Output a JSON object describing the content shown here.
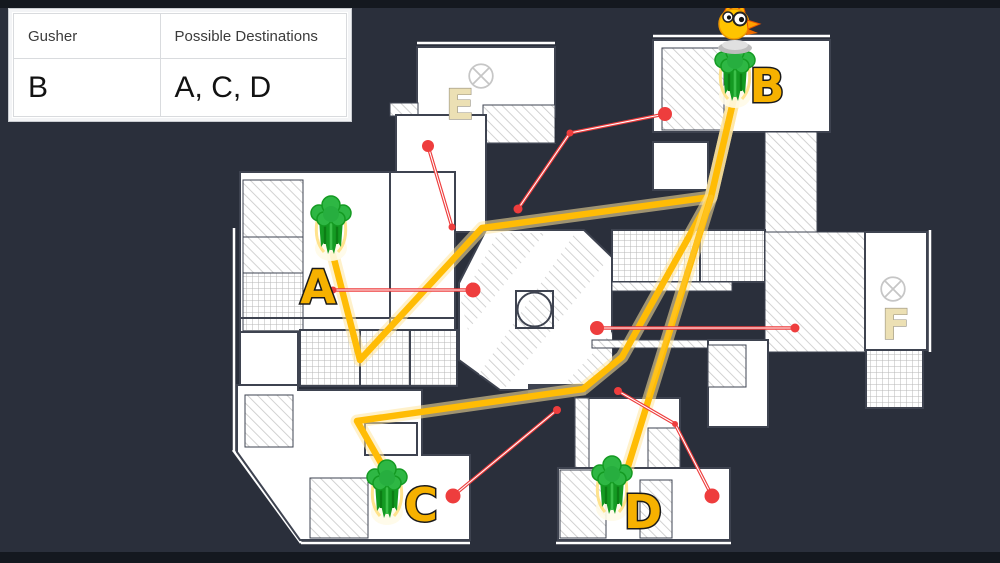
{
  "table": {
    "headers": [
      "Gusher",
      "Possible Destinations"
    ],
    "rows": [
      {
        "gusher": "B",
        "destinations": "A, C, D"
      }
    ]
  },
  "map": {
    "colors": {
      "background": "#2a2f3b",
      "letterbox": "#14181f",
      "path_yellow": "#ffbc05",
      "callout_red": "#ee3d3d",
      "gusher_label_yellow": "#f6b100",
      "site_label_cream": "#ece0b4",
      "gusher_green": "#149a22"
    },
    "gushers": [
      {
        "id": "A",
        "label": "A",
        "icon_x": 331,
        "icon_y": 228,
        "label_x": 318,
        "label_y": 303,
        "has_character": false
      },
      {
        "id": "B",
        "label": "B",
        "icon_x": 735,
        "icon_y": 75,
        "label_x": 767,
        "label_y": 102,
        "has_character": true
      },
      {
        "id": "C",
        "label": "C",
        "icon_x": 387,
        "icon_y": 492,
        "label_x": 421,
        "label_y": 521,
        "has_character": false
      },
      {
        "id": "D",
        "label": "D",
        "icon_x": 612,
        "icon_y": 488,
        "label_x": 643,
        "label_y": 528,
        "has_character": false
      }
    ],
    "sites": [
      {
        "id": "E",
        "label": "E",
        "label_x": 460,
        "label_y": 119,
        "marker_x": 481,
        "marker_y": 76
      },
      {
        "id": "F",
        "label": "F",
        "label_x": 896,
        "label_y": 339,
        "marker_x": 893,
        "marker_y": 289
      }
    ],
    "paths": [
      {
        "from": "B",
        "to": "A",
        "points": "734,98 711,197 482,228 360,360 333,255"
      },
      {
        "from": "B",
        "to": "C",
        "points": "734,98 711,197 622,357 583,389 357,421 381,463"
      },
      {
        "from": "B",
        "to": "D",
        "points": "734,98 711,197 626,473"
      }
    ],
    "ghost_path": {
      "points": "711,197 648,395"
    },
    "callouts": [
      {
        "points": "333,290 473,290",
        "dots": [
          {
            "x": 473,
            "y": 290,
            "r": 7.5
          },
          {
            "x": 333,
            "y": 290,
            "r": 3.5
          }
        ]
      },
      {
        "points": "428,146 452,227",
        "dots": [
          {
            "x": 428,
            "y": 146,
            "r": 6
          },
          {
            "x": 452,
            "y": 227,
            "r": 3.5
          }
        ]
      },
      {
        "points": "518,209 570,133 665,114",
        "dots": [
          {
            "x": 665,
            "y": 114,
            "r": 7
          },
          {
            "x": 570,
            "y": 133,
            "r": 3.5
          },
          {
            "x": 518,
            "y": 209,
            "r": 4.5
          }
        ]
      },
      {
        "points": "597,328 795,328",
        "dots": [
          {
            "x": 597,
            "y": 328,
            "r": 7
          },
          {
            "x": 795,
            "y": 328,
            "r": 4.5
          }
        ]
      },
      {
        "points": "557,410 453,496",
        "dots": [
          {
            "x": 453,
            "y": 496,
            "r": 7.5
          },
          {
            "x": 557,
            "y": 410,
            "r": 4
          }
        ]
      },
      {
        "points": "618,391 675,424 712,496",
        "dots": [
          {
            "x": 712,
            "y": 496,
            "r": 7.5
          },
          {
            "x": 618,
            "y": 391,
            "r": 4
          },
          {
            "x": 675,
            "y": 424,
            "r": 3
          }
        ]
      }
    ]
  }
}
